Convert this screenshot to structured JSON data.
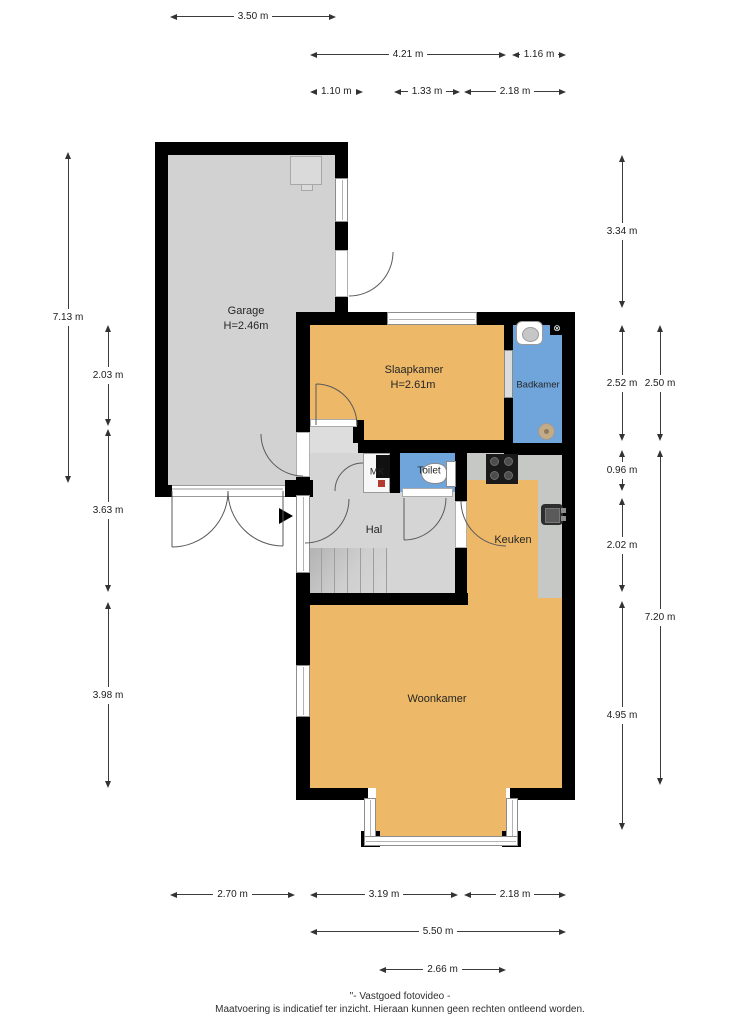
{
  "rooms": {
    "garage": {
      "name": "Garage",
      "ceiling_height": "H=2.46m"
    },
    "slaapkamer": {
      "name": "Slaapkamer",
      "ceiling_height": "H=2.61m"
    },
    "badkamer": {
      "name": "Badkamer"
    },
    "mk": {
      "name": "MK"
    },
    "toilet": {
      "name": "Toilet"
    },
    "hal": {
      "name": "Hal"
    },
    "keuken": {
      "name": "Keuken"
    },
    "woonkamer": {
      "name": "Woonkamer"
    }
  },
  "dims": {
    "top": [
      {
        "label": "3.50 m"
      },
      {
        "label": "4.21 m"
      },
      {
        "label": "1.16 m"
      },
      {
        "label": "1.10 m"
      },
      {
        "label": "1.33 m"
      },
      {
        "label": "2.18 m"
      }
    ],
    "left": [
      {
        "label": "7.13 m"
      },
      {
        "label": "2.03 m"
      },
      {
        "label": "3.63 m"
      },
      {
        "label": "3.98 m"
      }
    ],
    "right": [
      {
        "label": "3.34 m"
      },
      {
        "label": "2.52 m"
      },
      {
        "label": "2.50 m"
      },
      {
        "label": "0.96 m"
      },
      {
        "label": "2.02 m"
      },
      {
        "label": "7.20 m"
      },
      {
        "label": "4.95 m"
      }
    ],
    "bottom": [
      {
        "label": "2.70 m"
      },
      {
        "label": "3.19 m"
      },
      {
        "label": "2.18 m"
      },
      {
        "label": "5.50 m"
      },
      {
        "label": "2.66 m"
      }
    ]
  },
  "symbols": {
    "entrance_arrow": "▶",
    "ventilation": "⊗"
  },
  "footer": {
    "line1": "\"- Vastgoed fotovideo -",
    "line2": "Maatvoering is indicatief ter inzicht. Hieraan kunnen geen rechten ontleend worden."
  },
  "colors": {
    "room_orange": "#EDB867",
    "room_blue": "#6FA5DA",
    "garage_gray": "#D2D2D2",
    "hal_gray": "#D5D5D5",
    "vestibule_gray": "#DDDDDD",
    "counter_gray": "#C6C8C6",
    "wall_black": "#000000",
    "background": "#FFFFFF"
  }
}
